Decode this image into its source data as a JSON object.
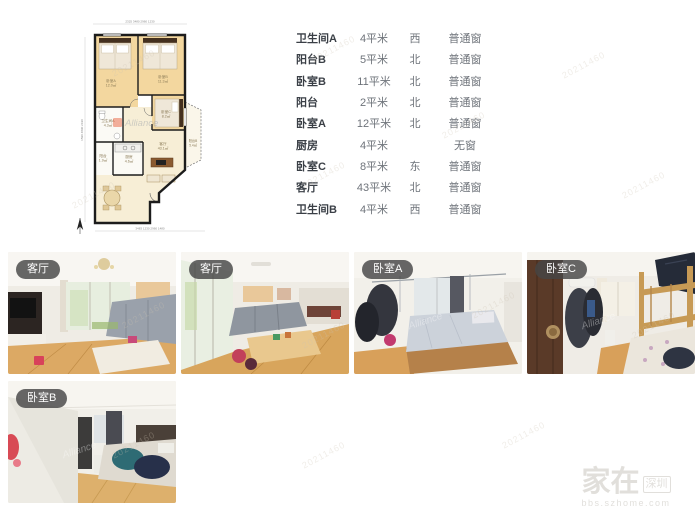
{
  "room_table": {
    "rows": [
      {
        "name": "卫生间A",
        "area": "4平米",
        "direction": "西",
        "window": "普通窗"
      },
      {
        "name": "阳台B",
        "area": "5平米",
        "direction": "北",
        "window": "普通窗"
      },
      {
        "name": "卧室B",
        "area": "11平米",
        "direction": "北",
        "window": "普通窗"
      },
      {
        "name": "阳台",
        "area": "2平米",
        "direction": "北",
        "window": "普通窗"
      },
      {
        "name": "卧室A",
        "area": "12平米",
        "direction": "北",
        "window": "普通窗"
      },
      {
        "name": "厨房",
        "area": "4平米",
        "direction": "",
        "window": "无窗"
      },
      {
        "name": "卧室C",
        "area": "8平米",
        "direction": "东",
        "window": "普通窗"
      },
      {
        "name": "客厅",
        "area": "43平米",
        "direction": "北",
        "window": "普通窗"
      },
      {
        "name": "卫生间B",
        "area": "4平米",
        "direction": "西",
        "window": "普通窗"
      }
    ]
  },
  "floorplan": {
    "dims_top": "2325        3480        2960        1230",
    "dims_bottom": "3483      1230      2960      1480",
    "dims_left": "1590      4890      2190",
    "rooms": {
      "bedroomA": {
        "name": "卧室A",
        "area": "12.0㎡"
      },
      "bedroomB": {
        "name": "卧室B",
        "area": "11.3㎡"
      },
      "bathroomA": {
        "name": "卫生间A",
        "area": "4.3㎡"
      },
      "balcony": {
        "name": "阳台",
        "area": "1.9㎡"
      },
      "kitchen": {
        "name": "厨房",
        "area": "4.6㎡"
      },
      "bedroomC": {
        "name": "卧室C",
        "area": "8.2㎡"
      },
      "living": {
        "name": "客厅",
        "area": "43.1㎡"
      },
      "balconyB": {
        "name": "阳台B",
        "area": "5.4㎡"
      }
    }
  },
  "photos": {
    "row1": [
      {
        "label": "客厅"
      },
      {
        "label": "客厅"
      },
      {
        "label": "卧室A"
      },
      {
        "label": "卧室C"
      }
    ],
    "row2": [
      {
        "label": "卧室B"
      }
    ]
  },
  "watermark": {
    "tile": "20211460",
    "alliance": "Alliance",
    "site_name_big": "家在",
    "site_city": "深圳",
    "site_url": "bbs.szhome.com"
  },
  "colors": {
    "wall": "#1c1c1c",
    "room_fill": "#f3d79f",
    "living_fill": "#f7eed6",
    "badge_bg": "#464646",
    "accent_orange": "#e8542e"
  }
}
